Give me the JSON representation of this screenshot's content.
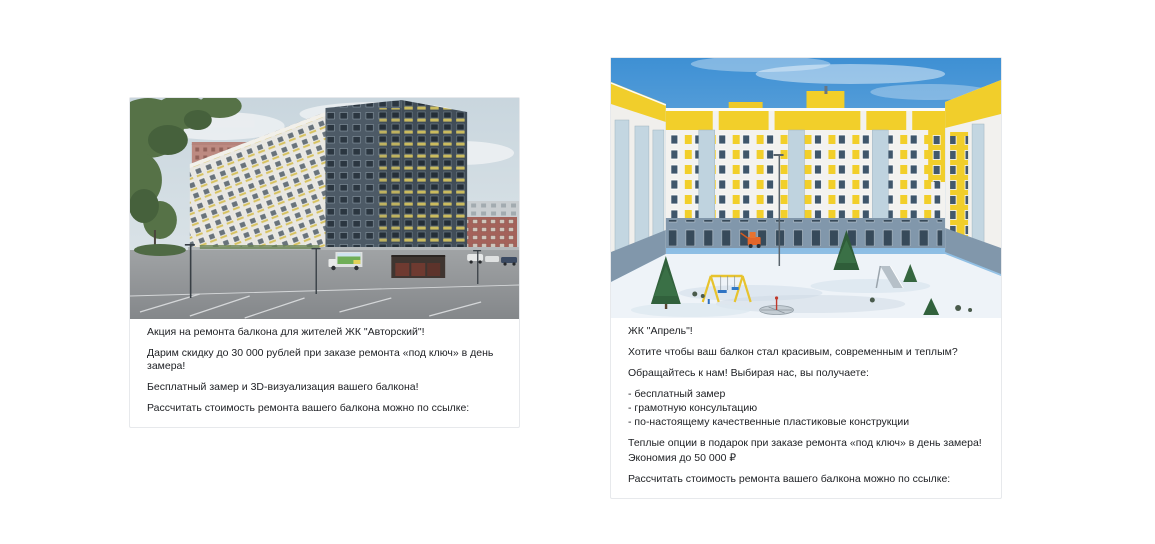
{
  "page": {
    "background": "#ffffff"
  },
  "left_post": {
    "photo": {
      "palette": {
        "sky": "#ccd8e0",
        "tower": "#4d5a66",
        "white_building": "#e9e7e1",
        "salmon_building": "#bd8a81",
        "balcony_yellow": "#cfc165",
        "asphalt": "#94979a",
        "trees": "#567247"
      }
    },
    "paragraphs": [
      "Акция на ремонта балкона для жителей ЖК \"Авторский\"!",
      "Дарим скидку до 30 000 рублей при заказе ремонта «под ключ» в день замера!",
      "Бесплатный замер и 3D-визуализация вашего балкона!",
      "Рассчитать стоимость ремонта вашего балкона можно по ссылке:"
    ]
  },
  "right_post": {
    "photo": {
      "palette": {
        "sky": "#3e90d4",
        "wall": "#f3f2ef",
        "accent_yellow": "#f2cf2a",
        "base_floor": "#8197ab",
        "snow": "#eef3f8",
        "fir": "#2f5d39",
        "swing_seat": "#2f74c4"
      }
    },
    "paragraphs": [
      "ЖК \"Апрель\"!",
      "Хотите чтобы ваш балкон стал красивым, современным и теплым?",
      "Обращайтесь к нам! Выбирая нас, вы получаете:",
      "- бесплатный замер",
      "- грамотную консультацию",
      "- по-настоящему качественные пластиковые конструкции",
      "Теплые опции в подарок при заказе ремонта «под ключ» в день замера!",
      "Экономия до 50 000 ₽",
      "Рассчитать стоимость ремонта вашего балкона можно по ссылке:"
    ]
  }
}
